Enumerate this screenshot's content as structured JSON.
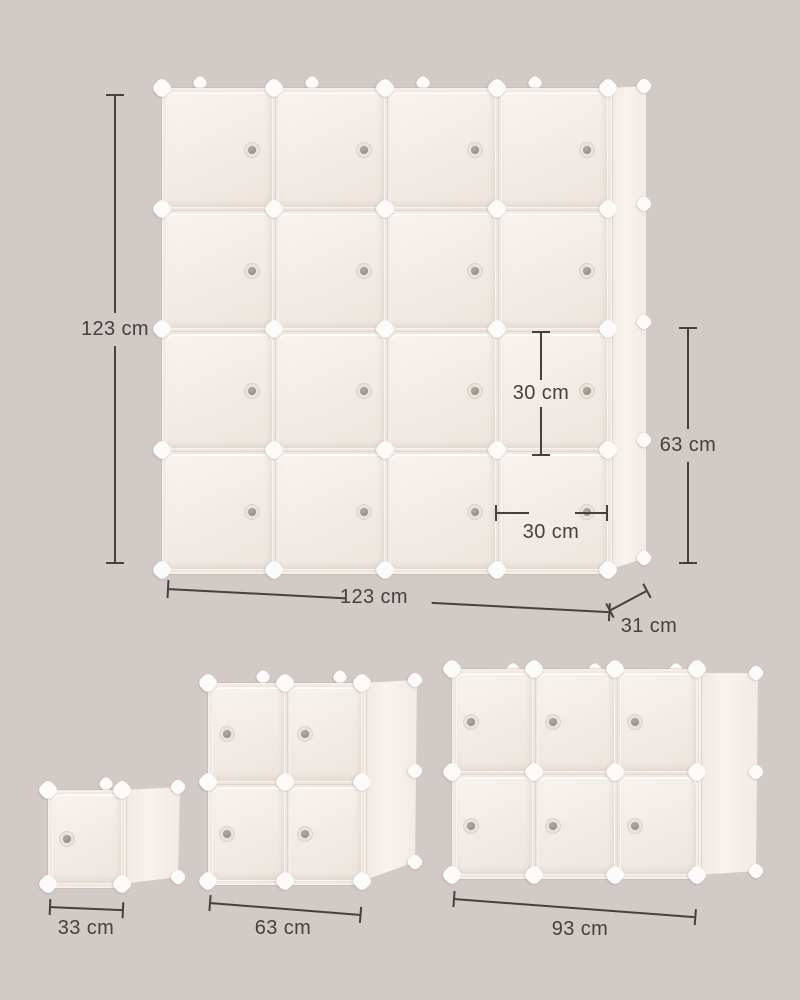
{
  "title": "Cube storage organizer dimension diagram",
  "colors": {
    "background": "#d1cac6",
    "panel": "#f2ebe5",
    "panel_light": "#f8f3ee",
    "seam": "#ddd6d0",
    "connector": "#fdfbf9",
    "knob": "#9a928b",
    "dimension_line": "#45413e"
  },
  "units": {
    "main": {
      "name": "4x4 cube organizer",
      "cols": 4,
      "rows": 4,
      "cube_count": 16,
      "knob_side": "right",
      "dims": {
        "height_label": "123 cm",
        "width_label": "123 cm",
        "depth_label": "31 cm",
        "two_cube_height_label": "63 cm",
        "cube_inner_height_label": "30 cm",
        "cube_inner_width_label": "30 cm"
      }
    },
    "single": {
      "name": "1x1 cube",
      "cols": 1,
      "rows": 1,
      "cube_count": 1,
      "knob_side": "left",
      "dims": {
        "width_label": "33 cm"
      }
    },
    "two_by_two": {
      "name": "2x2 cube organizer",
      "cols": 2,
      "rows": 2,
      "cube_count": 4,
      "knob_side": "left",
      "dims": {
        "width_label": "63 cm"
      }
    },
    "three_by_two": {
      "name": "3x2 cube organizer",
      "cols": 3,
      "rows": 2,
      "cube_count": 6,
      "knob_side": "left",
      "dims": {
        "width_label": "93 cm"
      }
    }
  }
}
